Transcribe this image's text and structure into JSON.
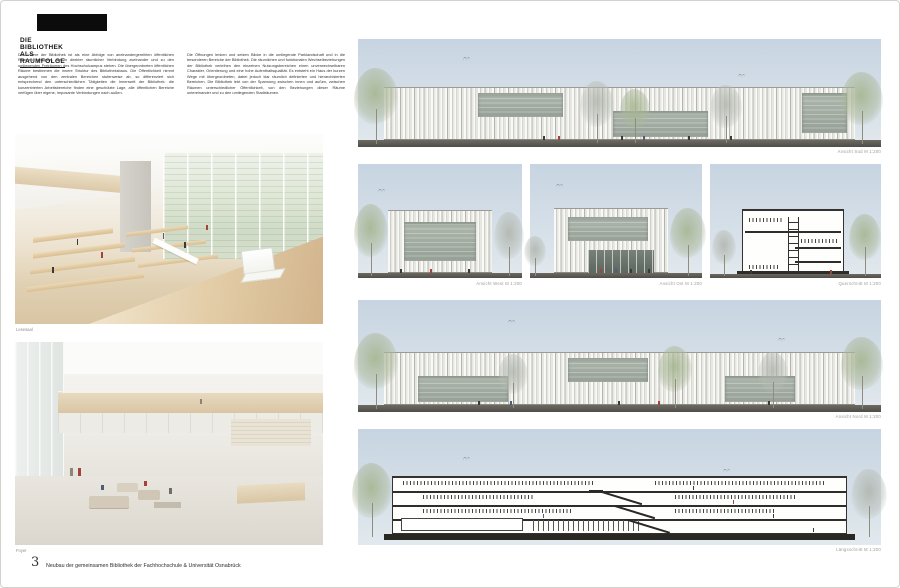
{
  "header": {
    "title": "DIE BIBLIOTHEK ALS RAUMFOLGE"
  },
  "intro": {
    "column1": "Das Innere der Bibliothek ist als eine Abfolge von aneinandergereihten öffentlichen Räumen konzipiert, die in direkter räumlicher Verbindung zueinander und zu den umliegenden Freiräumen des Hochschulcampus stehen. Die übergeordneten öffentlichen Räume bestimmen die innere Struktur des Bibliotheksbaus. Die Öffentlichkeit nimmt ausgehend von den zentralen Bereichen stufenweise ab, so differenziert sich entsprechend den unterschiedlichen Tätigkeiten die Innenwelt der Bibliothek: die konzentrierten Arbeitsbereiche finden eine geschützte Lage, alle öffentlichen Bereiche verfügen über eigene, imposante Verbindungen nach außen.",
    "column2": "Die Öffnungen lenken und setzen Blicke in die umliegende Parklandschaft und in die besonderen Bereiche der Bibliothek. Die räumlichen und funktionalen Wechselbeziehungen der Bibliothek verleihen den einzelnen Nutzungsbereichen einen unverwechselbaren Charakter, Orientierung und eine hohe Aufenthaltsqualität. Es entsteht ein Haus der kurzen Wege mit übergeordneten, dabei jedoch klar räumlich definierten und hierarchisierten Bereichen. Die Bibliothek lebt von der Spannung zwischen innen und außen, zwischen Räumen unterschiedlicher Öffentlichkeit, von den Beziehungen dieser Räume untereinander und zu den umliegenden Stadträumen."
  },
  "renderings": [
    {
      "caption": "Lesesaal"
    },
    {
      "caption": "Foyer"
    }
  ],
  "drawings": [
    {
      "label": "Ansicht Süd M 1:200"
    },
    {
      "label": "Ansicht West M 1:200"
    },
    {
      "label": "Ansicht Ost M 1:200"
    },
    {
      "label": "Querschnitt M 1:200"
    },
    {
      "label": "Ansicht Nord M 1:200"
    },
    {
      "label": "Längsschnitt M 1:200"
    }
  ],
  "footer": {
    "number": "3",
    "caption": "Neubau der gemeinsamen Bibliothek der Fachhochschule & Universität Osnabrück"
  },
  "colors": {
    "sky": "#cdd9e4",
    "ground": "#55534d",
    "facade_line": "#b4b4ac",
    "glass": "#a3ada2",
    "wood": "#d8c4a2",
    "tree_green": "#a9b792",
    "section_line": "#2e2d29",
    "accent_red": "#a0443c",
    "accent_blue": "#4c5f74"
  }
}
